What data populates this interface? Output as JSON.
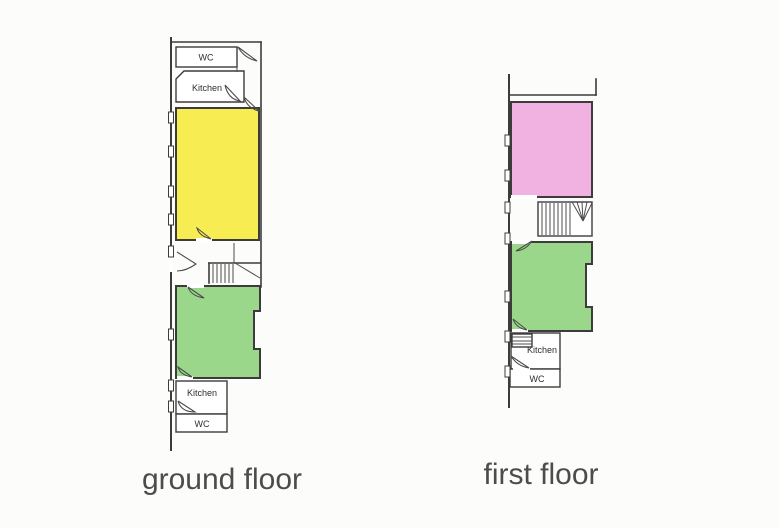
{
  "colors": {
    "yellow": "#f7ec52",
    "green": "#9bd78a",
    "pink": "#f1b2e2",
    "wall": "#3c3c3c",
    "caption_text": "#4c4c4c",
    "room_label_text": "#2e2e2e",
    "background": "#fcfcfb"
  },
  "ground_floor": {
    "caption": "ground floor",
    "rooms": {
      "wc_top": "WC",
      "kitchen_top": "Kitchen",
      "kitchen_bottom": "Kitchen",
      "wc_bottom": "WC"
    }
  },
  "first_floor": {
    "caption": "first floor",
    "rooms": {
      "kitchen": "Kitchen",
      "wc": "WC"
    }
  }
}
